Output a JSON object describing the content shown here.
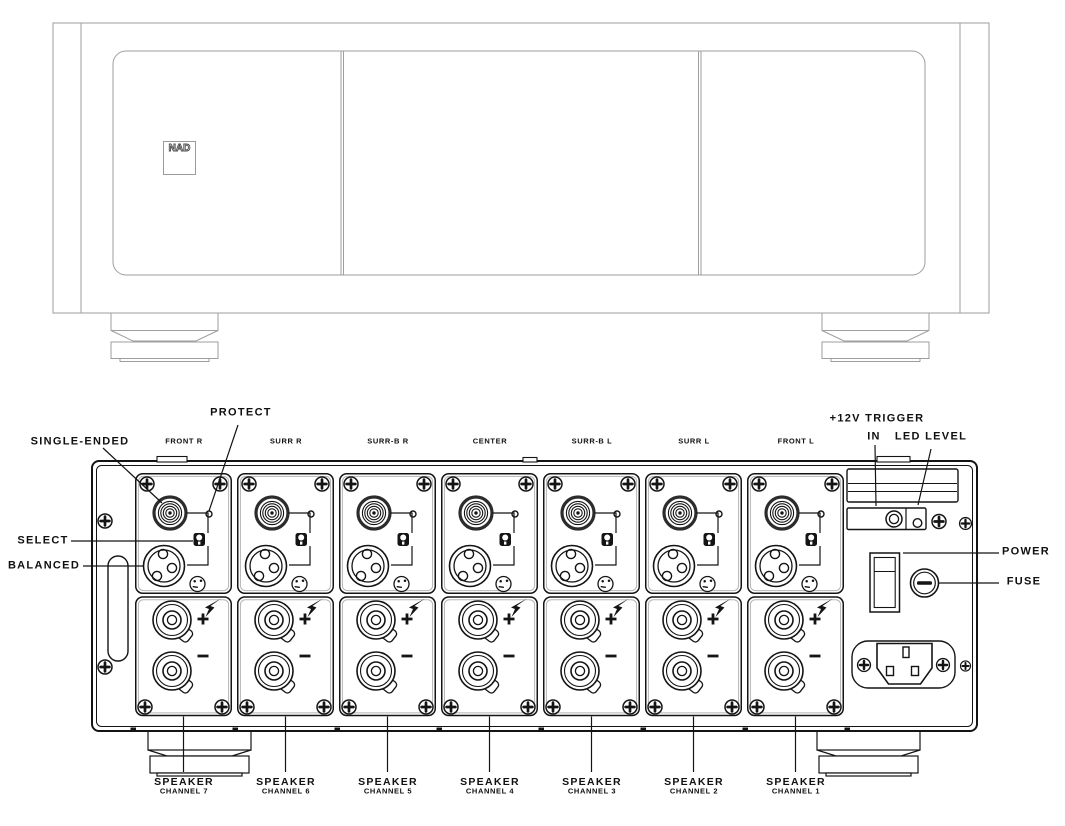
{
  "front": {
    "logo_text": "NAD"
  },
  "rear": {
    "channel_labels": [
      "FRONT R",
      "SURR R",
      "SURR-B R",
      "CENTER",
      "SURR-B L",
      "SURR L",
      "FRONT L"
    ],
    "callouts": {
      "single_ended": "SINGLE-ENDED",
      "protect": "PROTECT",
      "select": "SELECT",
      "balanced": "BALANCED",
      "trigger_line1": "+12V TRIGGER",
      "trigger_line2": "IN",
      "led_level": "LED LEVEL",
      "power": "POWER",
      "fuse": "FUSE"
    },
    "speaker_channels": [
      {
        "title": "SPEAKER",
        "subtitle": "CHANNEL 7"
      },
      {
        "title": "SPEAKER",
        "subtitle": "CHANNEL 6"
      },
      {
        "title": "SPEAKER",
        "subtitle": "CHANNEL 5"
      },
      {
        "title": "SPEAKER",
        "subtitle": "CHANNEL 4"
      },
      {
        "title": "SPEAKER",
        "subtitle": "CHANNEL 3"
      },
      {
        "title": "SPEAKER",
        "subtitle": "CHANNEL 2"
      },
      {
        "title": "SPEAKER",
        "subtitle": "CHANNEL 1"
      }
    ]
  },
  "icons": {
    "screw": "phillips-screw-icon",
    "rca": "rca-jack-icon",
    "xlr": "xlr-jack-icon",
    "select_switch": "select-switch-icon",
    "protect_led": "protect-led-icon",
    "pinout": "xlr-pinout-icon",
    "binding_post": "speaker-binding-post-icon",
    "plus": "plus-polarity-icon",
    "minus": "minus-polarity-icon",
    "lightning": "lightning-bolt-icon",
    "vent": "vent-grille-icon",
    "trigger_jack": "trigger-jack-icon",
    "power_switch": "power-rocker-icon",
    "fuse_holder": "fuse-holder-icon",
    "ac_inlet": "ac-inlet-icon"
  },
  "colors": {
    "ink": "#141414",
    "front_line": "#9e9e9e",
    "module_shadow": "#b5b5b5",
    "background": "#ffffff"
  }
}
